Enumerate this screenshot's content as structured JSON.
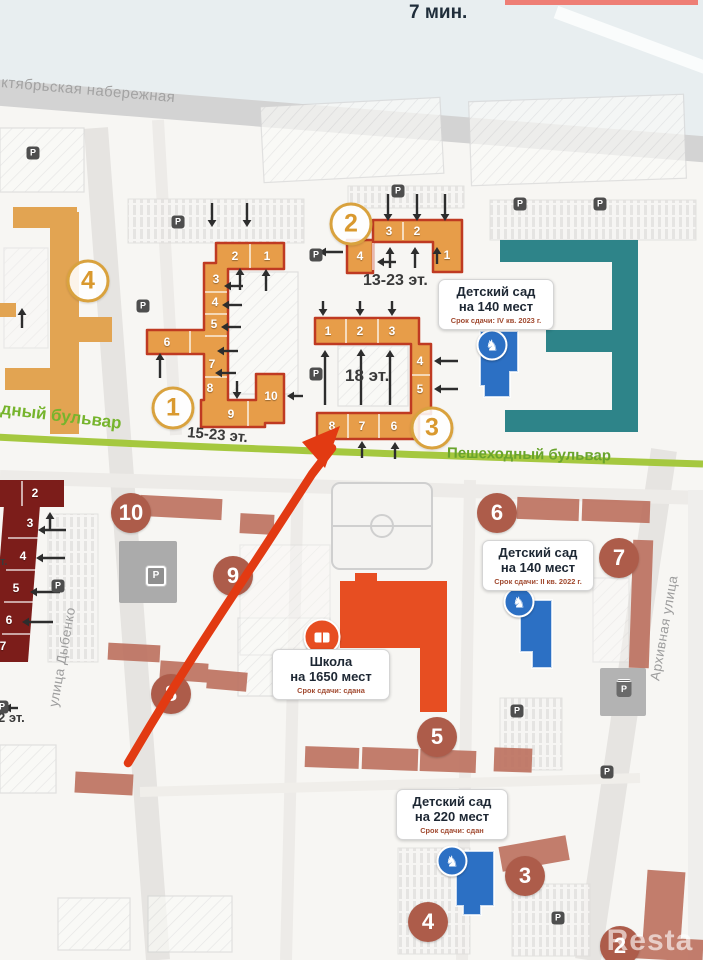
{
  "meta": {
    "walk_time": "7 мин.",
    "watermark": "Resta"
  },
  "streets": {
    "embankment": "ктябрьская набережная",
    "dybenko": "улица Дыбенко",
    "arkhivnaya": "Архивная улица",
    "boulevard_left": "дный бульвар",
    "boulevard_right": "Пешеходный бульвар"
  },
  "colors": {
    "orange_building": "#e79d49",
    "orange_outline": "#bf3a22",
    "amber_building": "#e2a452",
    "teal_building": "#2e8489",
    "dark_red_building": "#7c1d1a",
    "terracotta_building": "#bd7260",
    "school_red": "#e74e22",
    "kindergarten_blue": "#2c70c4",
    "boulevard_green": "#a5c83f",
    "built_circle": "#ad5c4a",
    "new_circle_number": "#d9992f",
    "deadline_text": "#a14a30"
  },
  "floor_labels": [
    {
      "text": "13-23 эт.",
      "x": 363,
      "y": 272,
      "rot": 0,
      "s": 16
    },
    {
      "text": "18 эт.",
      "x": 345,
      "y": 366,
      "rot": 0,
      "s": 17
    },
    {
      "text": "15-23 эт.",
      "x": 188,
      "y": 424,
      "rot": 5,
      "s": 15
    },
    {
      "text": "2 эт.",
      "x": -2,
      "y": 710,
      "rot": 0,
      "s": 13
    },
    {
      "text": "т.",
      "x": 0,
      "y": 556,
      "rot": 0,
      "s": 11
    }
  ],
  "phase_circles_new": [
    {
      "n": "2",
      "x": 351,
      "y": 224
    },
    {
      "n": "4",
      "x": 88,
      "y": 281
    },
    {
      "n": "1",
      "x": 173,
      "y": 408
    },
    {
      "n": "3",
      "x": 432,
      "y": 428
    }
  ],
  "phase_circles_built": [
    {
      "n": "10",
      "x": 131,
      "y": 513
    },
    {
      "n": "9",
      "x": 233,
      "y": 576
    },
    {
      "n": "8",
      "x": 171,
      "y": 694
    },
    {
      "n": "6",
      "x": 497,
      "y": 513
    },
    {
      "n": "7",
      "x": 619,
      "y": 558
    },
    {
      "n": "5",
      "x": 437,
      "y": 737
    },
    {
      "n": "3",
      "x": 525,
      "y": 876
    },
    {
      "n": "4",
      "x": 428,
      "y": 922
    },
    {
      "n": "2",
      "x": 620,
      "y": 946
    }
  ],
  "sections": [
    {
      "b": "2",
      "n": "4",
      "x": 360,
      "y": 256
    },
    {
      "b": "2",
      "n": "3",
      "x": 389,
      "y": 231
    },
    {
      "b": "2",
      "n": "2",
      "x": 417,
      "y": 231
    },
    {
      "b": "2",
      "n": "1",
      "x": 447,
      "y": 255
    },
    {
      "b": "1",
      "n": "2",
      "x": 235,
      "y": 256
    },
    {
      "b": "1",
      "n": "1",
      "x": 267,
      "y": 256
    },
    {
      "b": "1",
      "n": "3",
      "x": 216,
      "y": 279
    },
    {
      "b": "1",
      "n": "4",
      "x": 215,
      "y": 302
    },
    {
      "b": "1",
      "n": "5",
      "x": 214,
      "y": 324
    },
    {
      "b": "1",
      "n": "6",
      "x": 167,
      "y": 342
    },
    {
      "b": "1",
      "n": "7",
      "x": 212,
      "y": 364
    },
    {
      "b": "1",
      "n": "8",
      "x": 210,
      "y": 388
    },
    {
      "b": "1",
      "n": "9",
      "x": 231,
      "y": 414
    },
    {
      "b": "1",
      "n": "10",
      "x": 271,
      "y": 396
    },
    {
      "b": "3",
      "n": "1",
      "x": 328,
      "y": 331
    },
    {
      "b": "3",
      "n": "2",
      "x": 360,
      "y": 331
    },
    {
      "b": "3",
      "n": "3",
      "x": 392,
      "y": 331
    },
    {
      "b": "3",
      "n": "4",
      "x": 420,
      "y": 361
    },
    {
      "b": "3",
      "n": "5",
      "x": 420,
      "y": 389
    },
    {
      "b": "3",
      "n": "8",
      "x": 332,
      "y": 426
    },
    {
      "b": "3",
      "n": "7",
      "x": 362,
      "y": 426
    },
    {
      "b": "3",
      "n": "6",
      "x": 394,
      "y": 426
    },
    {
      "b": "dr",
      "n": "2",
      "x": 35,
      "y": 493
    },
    {
      "b": "dr",
      "n": "3",
      "x": 30,
      "y": 523
    },
    {
      "b": "dr",
      "n": "4",
      "x": 23,
      "y": 556
    },
    {
      "b": "dr",
      "n": "5",
      "x": 16,
      "y": 588
    },
    {
      "b": "dr",
      "n": "6",
      "x": 9,
      "y": 620
    },
    {
      "b": "dr",
      "n": "7",
      "x": 3,
      "y": 646
    }
  ],
  "info_boxes": [
    {
      "id": "kindergarten-1",
      "x": 438,
      "y": 279,
      "w": 110,
      "l1": "Детский сад",
      "l2": "на 140 мест",
      "srok": "Срок сдачи: IV кв. 2023 г."
    },
    {
      "id": "kindergarten-2",
      "x": 482,
      "y": 540,
      "w": 106,
      "l1": "Детский сад",
      "l2": "на 140 мест",
      "srok": "Срок сдачи: II кв. 2022 г."
    },
    {
      "id": "school",
      "x": 272,
      "y": 649,
      "w": 112,
      "l1": "Школа",
      "l2": "на 1650 мест",
      "srok": "Срок сдачи: сдана"
    },
    {
      "id": "kindergarten-3",
      "x": 396,
      "y": 789,
      "w": 106,
      "l1": "Детский сад",
      "l2": "на 220 мест",
      "srok": "Срок сдачи: сдан"
    }
  ],
  "p_icons": [
    {
      "t": "p",
      "x": 33,
      "y": 153
    },
    {
      "t": "p",
      "x": 178,
      "y": 222
    },
    {
      "t": "p",
      "x": 398,
      "y": 191
    },
    {
      "t": "p",
      "x": 316,
      "y": 255
    },
    {
      "t": "p",
      "x": 520,
      "y": 204
    },
    {
      "t": "p",
      "x": 600,
      "y": 204
    },
    {
      "t": "p",
      "x": 143,
      "y": 306
    },
    {
      "t": "p",
      "x": 316,
      "y": 374
    },
    {
      "t": "p",
      "x": 58,
      "y": 586
    },
    {
      "t": "pg",
      "x": 156,
      "y": 576
    },
    {
      "t": "pr",
      "x": 624,
      "y": 688
    },
    {
      "t": "p",
      "x": 517,
      "y": 711
    },
    {
      "t": "p",
      "x": 558,
      "y": 918
    },
    {
      "t": "p",
      "x": 607,
      "y": 772
    },
    {
      "t": "p",
      "x": 2,
      "y": 707
    }
  ],
  "horse_icons": [
    {
      "x": 492,
      "y": 345
    },
    {
      "x": 519,
      "y": 602
    },
    {
      "x": 452,
      "y": 861
    }
  ],
  "book_icon": {
    "x": 322,
    "y": 637,
    "glyph": "open-book"
  },
  "horse_glyph": "♞",
  "p_glyph": "P",
  "arrows": [
    [
      388,
      194,
      388,
      221
    ],
    [
      417,
      194,
      417,
      221
    ],
    [
      445,
      194,
      445,
      221
    ],
    [
      390,
      268,
      390,
      247
    ],
    [
      415,
      268,
      415,
      247
    ],
    [
      437,
      264,
      437,
      247
    ],
    [
      343,
      252,
      319,
      252
    ],
    [
      396,
      262,
      377,
      262
    ],
    [
      212,
      203,
      212,
      227
    ],
    [
      247,
      203,
      247,
      227
    ],
    [
      240,
      290,
      240,
      268
    ],
    [
      266,
      291,
      266,
      269
    ],
    [
      243,
      286,
      224,
      286
    ],
    [
      242,
      305,
      222,
      305
    ],
    [
      241,
      327,
      221,
      327
    ],
    [
      238,
      351,
      217,
      351
    ],
    [
      236,
      373,
      215,
      373
    ],
    [
      237,
      381,
      237,
      399
    ],
    [
      160,
      378,
      160,
      353
    ],
    [
      303,
      396,
      287,
      396
    ],
    [
      323,
      301,
      323,
      316
    ],
    [
      360,
      301,
      360,
      316
    ],
    [
      392,
      301,
      392,
      316
    ],
    [
      325,
      405,
      325,
      350
    ],
    [
      361,
      405,
      361,
      349
    ],
    [
      390,
      405,
      390,
      350
    ],
    [
      458,
      361,
      434,
      361
    ],
    [
      458,
      389,
      434,
      389
    ],
    [
      362,
      458,
      362,
      441
    ],
    [
      395,
      459,
      395,
      442
    ],
    [
      50,
      531,
      50,
      512
    ],
    [
      66,
      530,
      38,
      530
    ],
    [
      65,
      558,
      36,
      558
    ],
    [
      60,
      592,
      30,
      592
    ],
    [
      53,
      622,
      22,
      622
    ],
    [
      18,
      708,
      4,
      708
    ],
    [
      22,
      328,
      22,
      308
    ]
  ],
  "red_arrow": {
    "points": "128,763 150,726 172,690 196,652 220,615 243,580 266,545 290,508 312,474 332,448",
    "head": "340,426 302,442 325,468",
    "color": "#e23a12"
  }
}
